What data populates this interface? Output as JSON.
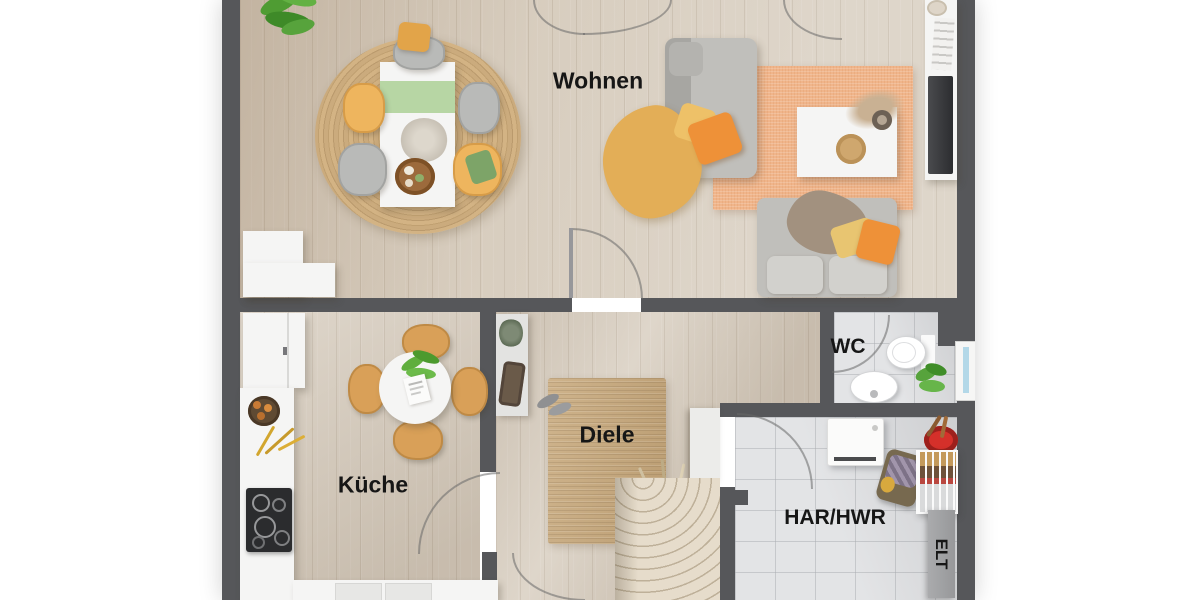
{
  "page": {
    "type": "3d-floor-plan-rendering",
    "background": "#ffffff"
  },
  "rooms": {
    "wohnen": {
      "label": "Wohnen"
    },
    "kueche": {
      "label": "Küche"
    },
    "diele": {
      "label": "Diele"
    },
    "wc": {
      "label": "WC"
    },
    "har_hwr": {
      "label": "HAR/HWR"
    },
    "elt": {
      "label": "ELT"
    }
  },
  "colors": {
    "wall": "#56575a",
    "wood_floor": "#d8cec0",
    "tile_floor": "#e3e4e6",
    "jute_rug": "#c8a97c",
    "peach_rug": "#f0b58b",
    "sofa_gray": "#c0bfbb",
    "accent_yellow": "#eeb55e",
    "accent_orange": "#ee9138",
    "runner_green": "#b7d6a4",
    "window_blue": "#b3d8e8",
    "bucket_red": "#d5302a",
    "elt_panel_gray": "#a0a1a3",
    "label_text": "#161616"
  },
  "furniture": {
    "wohnen": [
      "potted-palm",
      "round-jute-rug",
      "dining-table",
      "green-table-runner",
      "dining-chairs",
      "centerpiece-flowers",
      "serving-bowl",
      "sideboard",
      "chaise-longue",
      "yellow-throw",
      "cushions",
      "peach-rug",
      "coffee-table",
      "decorative-plate",
      "pampas-vase",
      "sofa",
      "tv-lowboard",
      "tv"
    ],
    "kueche": [
      "tall-cabinet",
      "fruit-bowl",
      "flower-sprigs",
      "kitchen-counter",
      "cooktop",
      "base-cabinets",
      "round-kitchen-table",
      "table-plant",
      "menu-card",
      "kitchen-chairs"
    ],
    "diele": [
      "wall-shelf",
      "bag",
      "shoes",
      "jute-runner-rug",
      "dried-grass",
      "winder-stairs"
    ],
    "wc": [
      "toilet",
      "washbasin",
      "plant",
      "window"
    ],
    "har_hwr": [
      "washing-machine",
      "red-bucket",
      "laundry-basket",
      "drying-rack",
      "electrical-panel"
    ]
  }
}
